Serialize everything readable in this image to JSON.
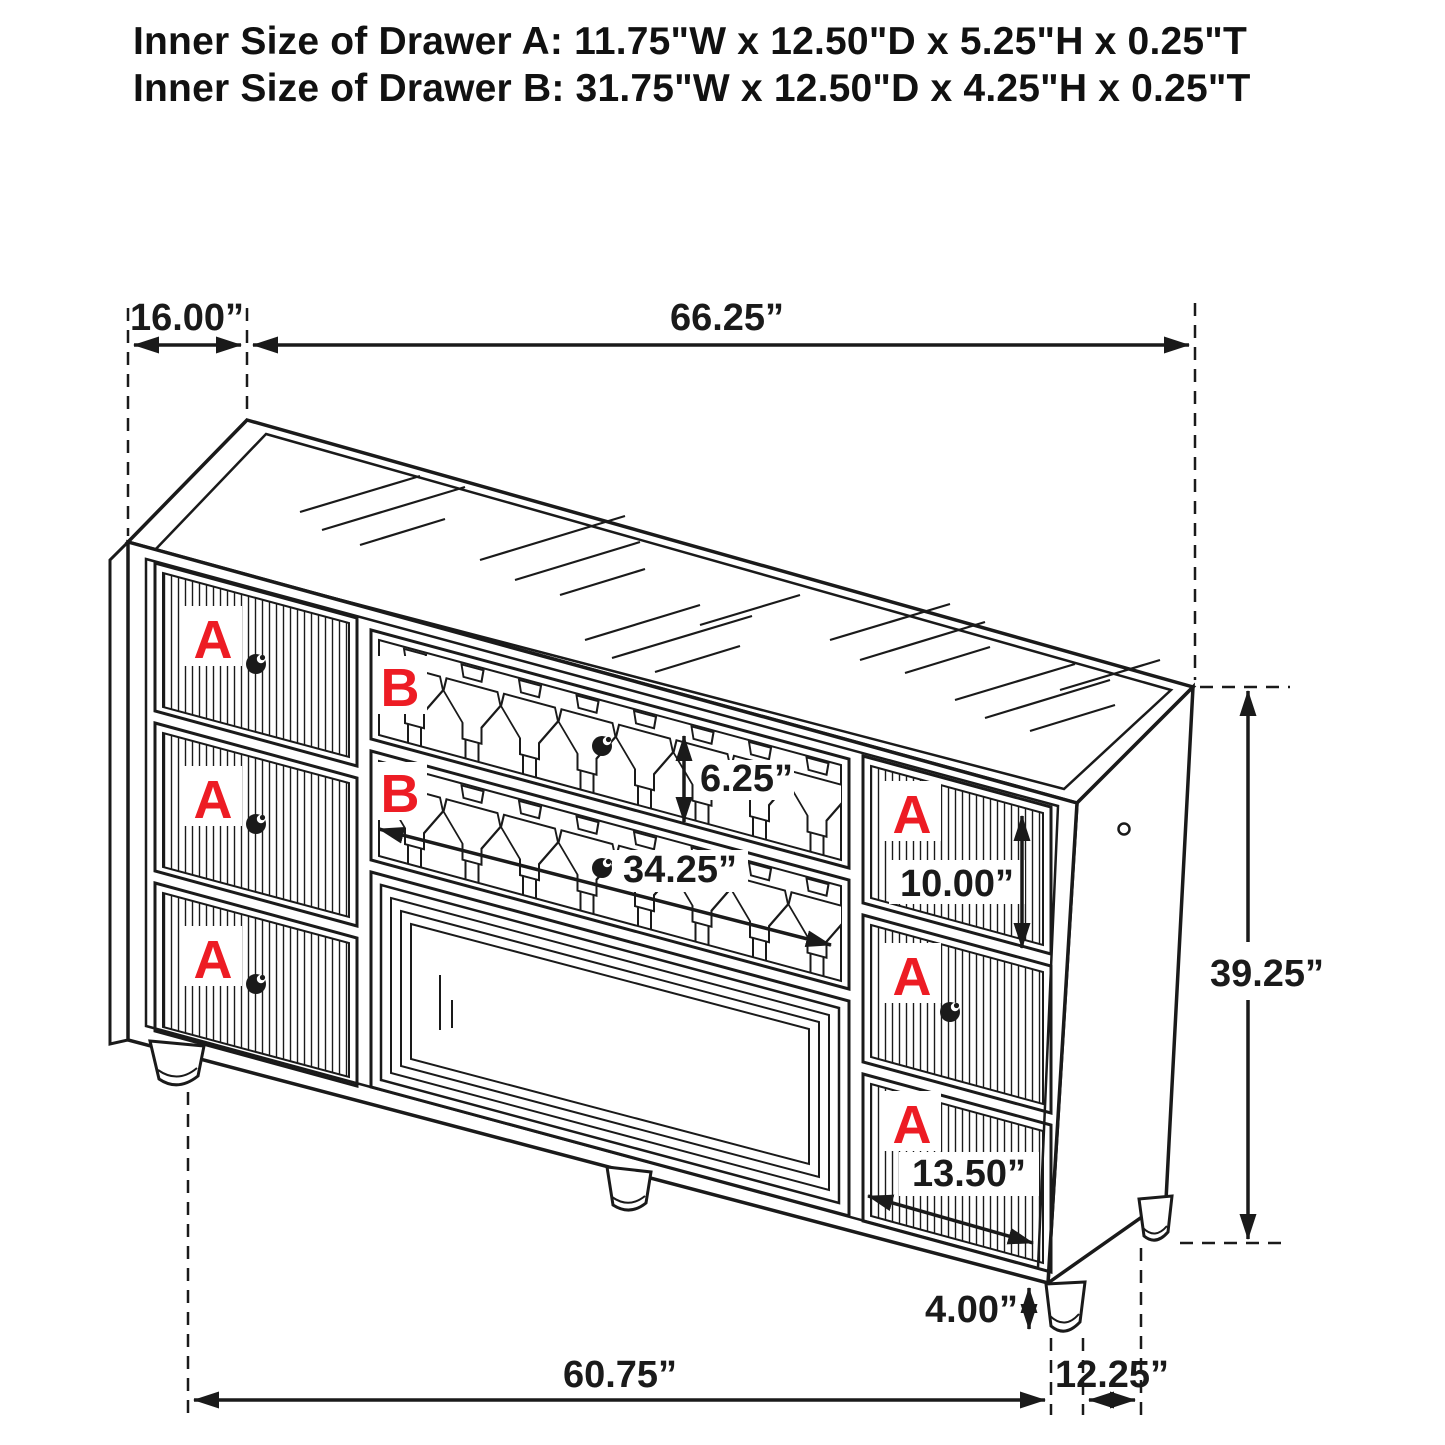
{
  "title": {
    "line1": "Inner Size of Drawer A: 11.75\"W x 12.50\"D x 5.25\"H x 0.25\"T",
    "line2": "Inner Size of Drawer B: 31.75\"W x 12.50\"D x 4.25\"H x 0.25\"T"
  },
  "dimensions": {
    "top_depth": "16.00”",
    "top_width": "66.25”",
    "drawer_b_height": "6.25”",
    "drawer_b_width": "34.25”",
    "right_drawer_height": "10.00”",
    "overall_height": "39.25”",
    "right_drawer_width": "13.50”",
    "leg_height": "4.00”",
    "base_width": "60.75”",
    "base_depth": "12.25”"
  },
  "drawer_labels": {
    "a": "A",
    "b": "B"
  },
  "colors": {
    "line": "#1a1a1a",
    "label_red": "#ed1c24",
    "background": "#ffffff"
  }
}
